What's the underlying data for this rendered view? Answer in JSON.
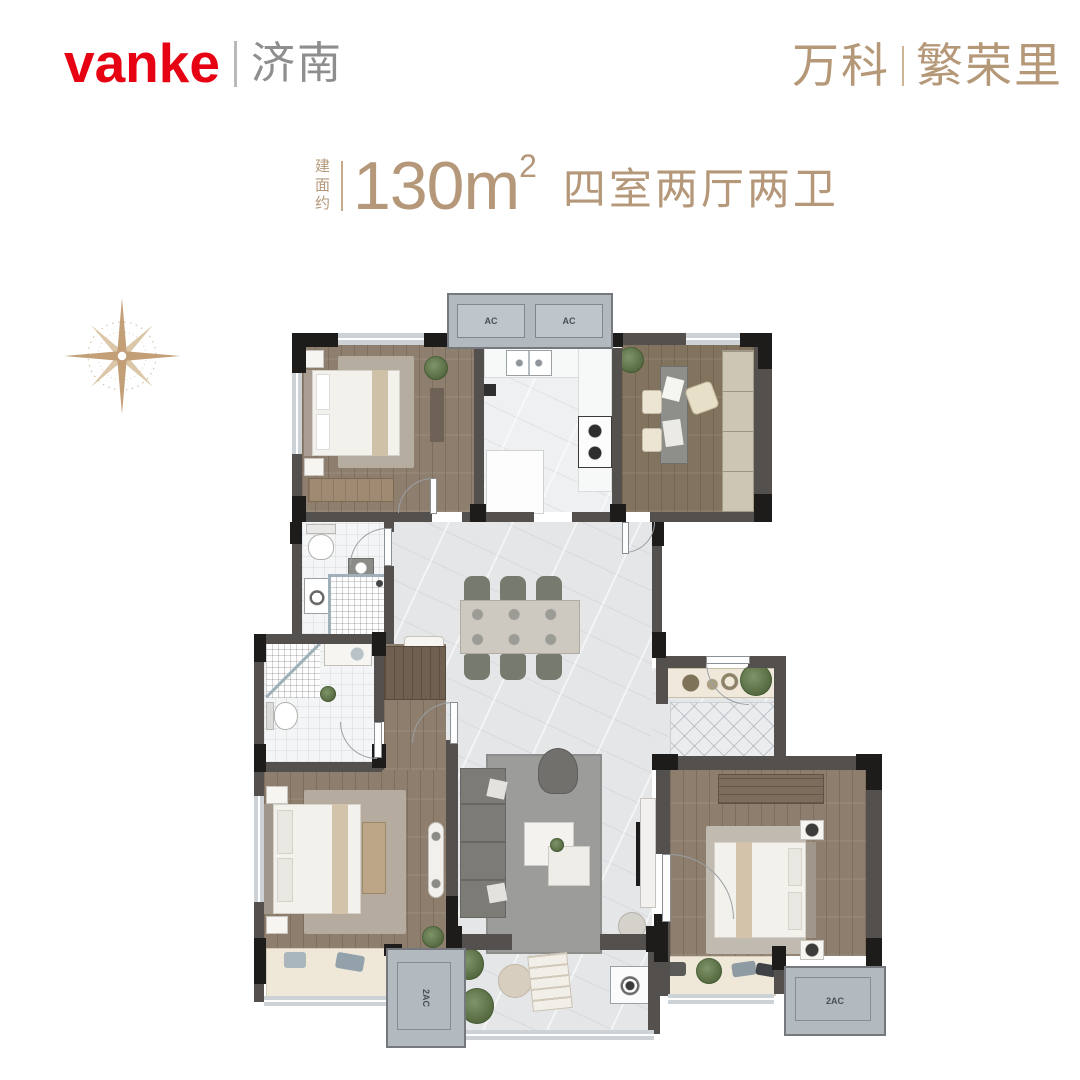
{
  "header": {
    "logo_text": "vanke",
    "logo_city": "济南",
    "project_name_1": "万科",
    "project_name_2": "繁荣里"
  },
  "title": {
    "area_prefix": "建面约",
    "area_value": "130m",
    "area_sup": "2",
    "layout_desc": "四室两厅两卫"
  },
  "plan": {
    "ac_units": [
      "AC",
      "AC"
    ],
    "ac_platform_bottom_left": "2AC",
    "ac_platform_bottom_right": "2AC"
  },
  "colors": {
    "brand_red": "#e60113",
    "brand_gold": "#b5987a",
    "wall_dark": "#54504d",
    "column_black": "#1d1c1b",
    "wood_floor": "#8d7e6d",
    "marble_floor": "#e4e6e8",
    "ac_platform": "#b2bac0"
  }
}
